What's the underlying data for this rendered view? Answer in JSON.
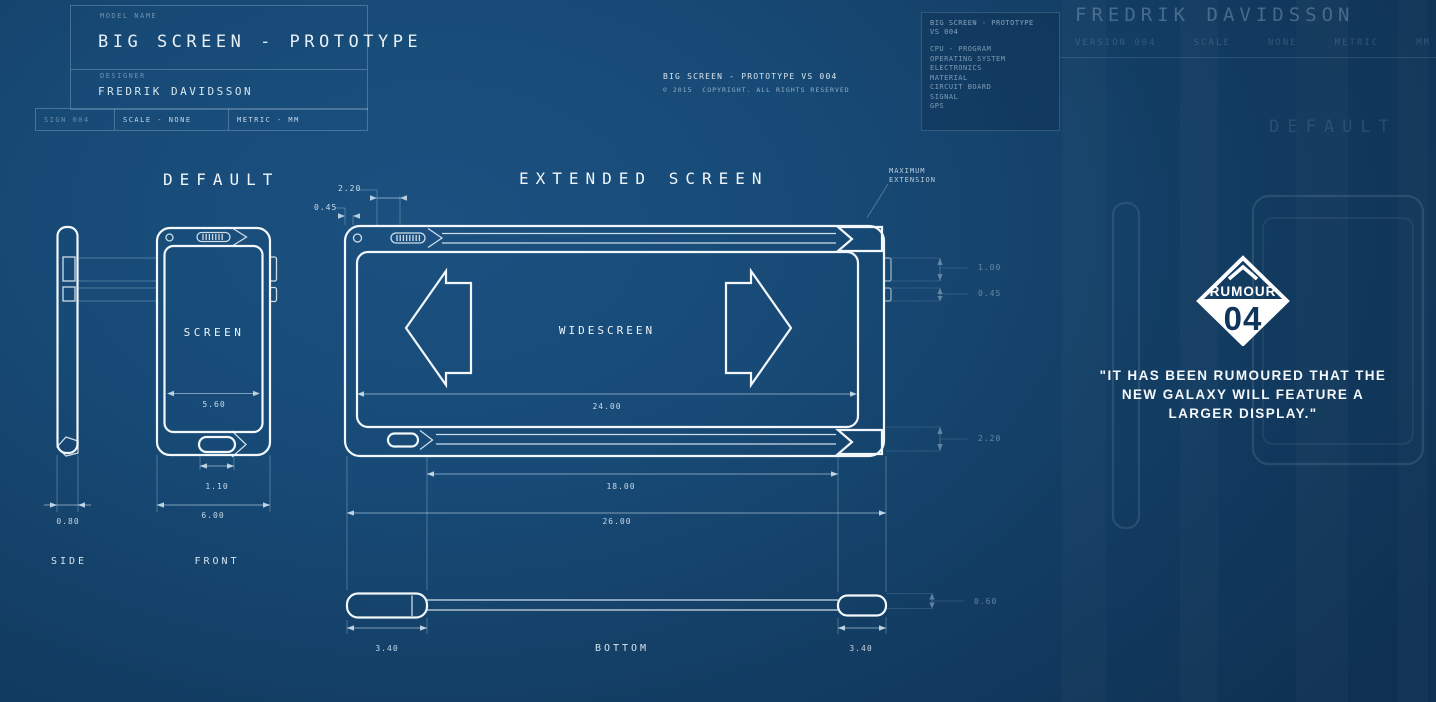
{
  "title_block": {
    "model_name_label": "MODEL NAME",
    "model_name": "BIG SCREEN - PROTOTYPE",
    "designer_label": "DESIGNER",
    "designer": "FREDRIK DAVIDSSON",
    "sign": "SIGN 004",
    "scale": "SCALE - NONE",
    "metric": "METRIC - MM"
  },
  "header_center": {
    "title": "BIG SCREEN - PROTOTYPE VS 004",
    "copyright": "© 2015  COPYRIGHT. ALL RIGHTS RESERVED"
  },
  "spec_panel": {
    "title_line1": "BIG SCREEN - PROTOTYPE",
    "title_line2": "VS 004",
    "items": [
      "CPU - PROGRAM",
      "OPERATING SYSTEM",
      "ELECTRONICS",
      "MATERIAL",
      "CIRCUIT BOARD",
      "SIGNAL",
      "GPS"
    ]
  },
  "ghost_header": {
    "designer": "FREDRIK DAVIDSSON",
    "meta": "VERSION 004     SCALE     NONE     METRIC     MM"
  },
  "default_view": {
    "heading": "DEFAULT",
    "screen_label": "SCREEN",
    "dim_screen_width": "5.60",
    "dim_home_width": "1.10",
    "dim_phone_width": "6.00",
    "dim_side_depth": "0.80",
    "side_label": "SIDE",
    "front_label": "FRONT"
  },
  "extended_view": {
    "heading": "EXTENDED SCREEN",
    "widescreen_label": "WIDESCREEN",
    "max_extension_label_1": "MAXIMUM",
    "max_extension_label_2": "EXTENSION",
    "dim_speaker": "2.20",
    "dim_camera": "0.45",
    "dim_screen": "24.00",
    "dim_track": "18.00",
    "dim_total": "26.00",
    "dim_button_1": "1.00",
    "dim_button_2": "0.45",
    "dim_bezel": "2.20",
    "dim_bar": "0.60",
    "dim_end_left": "3.40",
    "dim_end_right": "3.40",
    "bottom_label": "BOTTOM"
  },
  "rumour": {
    "badge_label": "RUMOUR",
    "badge_number": "04",
    "quote_line1": "\"IT HAS BEEN RUMOURED THAT THE",
    "quote_line2": "NEW GALAXY WILL FEATURE A",
    "quote_line3": "LARGER DISPLAY.\""
  },
  "ghost_view": {
    "heading": "DEFAULT"
  },
  "colors": {
    "background": "#16466f",
    "line": "#eef5fa",
    "badge_navy": "#0f355a"
  }
}
